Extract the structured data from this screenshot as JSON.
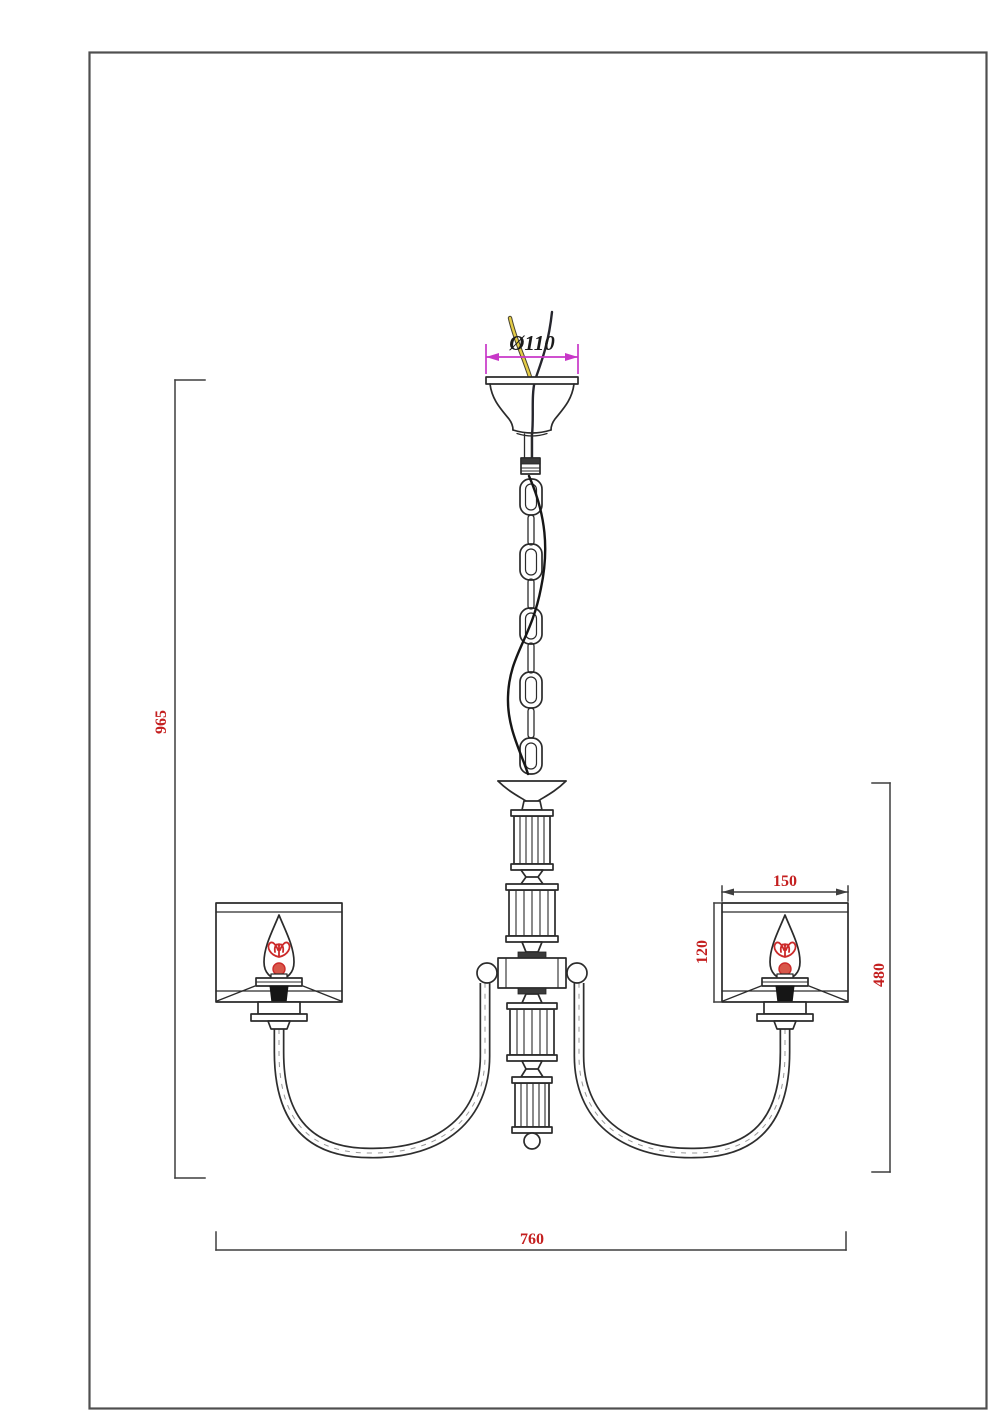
{
  "dims": {
    "canopy_diameter": "Ø110",
    "overall_height": "965",
    "body_height": "480",
    "overall_width": "760",
    "shade_width": "150",
    "shade_height": "120"
  },
  "colors": {
    "line": "#2b2b2b",
    "dimension_text": "#c41f1f",
    "canopy_dimension_line": "#c837c8",
    "filament": "#cc2a2a",
    "wire_yellow": "#e4cc45",
    "frame": "#4f4f4f"
  },
  "components": [
    "ceiling-canopy",
    "power-wires",
    "suspension-chain",
    "power-cord",
    "crystal-column",
    "arm-hub",
    "curved-arm-left",
    "curved-arm-right",
    "candle-bulb",
    "cylindrical-shade",
    "bottom-finial"
  ]
}
